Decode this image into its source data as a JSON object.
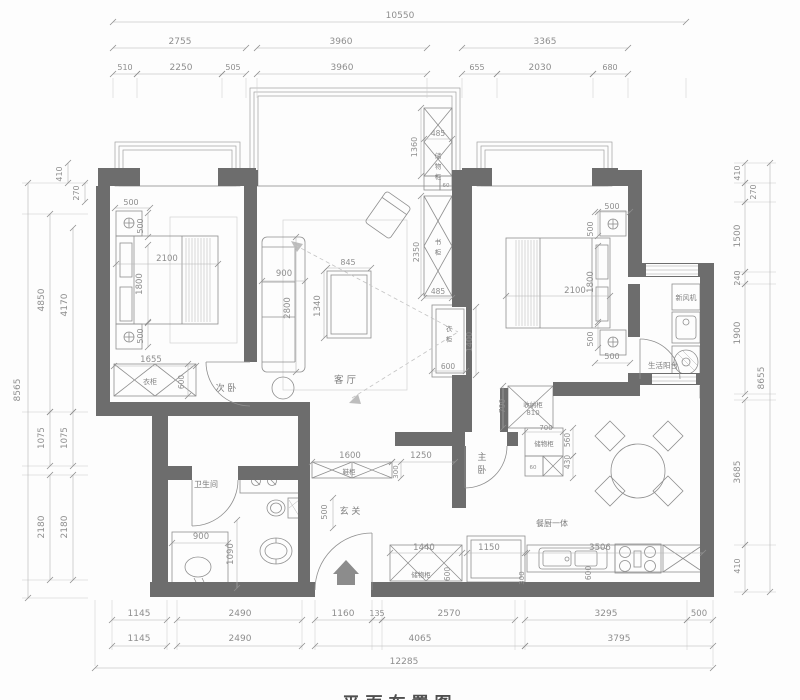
{
  "drawing": {
    "type": "apartment-floor-plan",
    "caption": "平面布置图",
    "room_labels": [
      "次 卧",
      "客 厅",
      "主卧",
      "玄 关",
      "卫生间",
      "餐厨一体",
      "生活阳台"
    ],
    "cabinet_labels": [
      "衣柜",
      "书柜",
      "储物柜",
      "收纳柜",
      "鞋柜",
      "新风机"
    ],
    "overall_dimensions": {
      "top": "10550",
      "bottom": "12285",
      "left": "8565",
      "right": "8655"
    },
    "annotations": [
      {
        "n": "dim-top-total",
        "t": "10550",
        "x": 400,
        "y": 18
      },
      {
        "n": "dim-top-2755",
        "t": "2755",
        "x": 180,
        "y": 44
      },
      {
        "n": "dim-top-3960a",
        "t": "3960",
        "x": 341,
        "y": 44
      },
      {
        "n": "dim-top-3365",
        "t": "3365",
        "x": 545,
        "y": 44
      },
      {
        "n": "dim-top-510",
        "t": "510",
        "x": 125,
        "y": 70,
        "s": 8
      },
      {
        "n": "dim-top-2250",
        "t": "2250",
        "x": 181,
        "y": 70
      },
      {
        "n": "dim-top-505",
        "t": "505",
        "x": 233,
        "y": 70,
        "s": 8
      },
      {
        "n": "dim-top-3960b",
        "t": "3960",
        "x": 342,
        "y": 70
      },
      {
        "n": "dim-top-655",
        "t": "655",
        "x": 477,
        "y": 70,
        "s": 8
      },
      {
        "n": "dim-top-2030",
        "t": "2030",
        "x": 540,
        "y": 70
      },
      {
        "n": "dim-top-680",
        "t": "680",
        "x": 610,
        "y": 70,
        "s": 8
      },
      {
        "n": "dim-left-8565",
        "t": "8565",
        "x": 20,
        "y": 390,
        "r": -90
      },
      {
        "n": "dim-left-4850",
        "t": "4850",
        "x": 44,
        "y": 300,
        "r": -90
      },
      {
        "n": "dim-left-4170",
        "t": "4170",
        "x": 67,
        "y": 305,
        "r": -90
      },
      {
        "n": "dim-left-410",
        "t": "410",
        "x": 62,
        "y": 174,
        "r": -90,
        "s": 8
      },
      {
        "n": "dim-left-270",
        "t": "270",
        "x": 79,
        "y": 193,
        "r": -90,
        "s": 8
      },
      {
        "n": "dim-left-1075a",
        "t": "1075",
        "x": 44,
        "y": 438,
        "r": -90,
        "s": 8.5
      },
      {
        "n": "dim-left-1075b",
        "t": "1075",
        "x": 67,
        "y": 438,
        "r": -90,
        "s": 8.5
      },
      {
        "n": "dim-left-2180a",
        "t": "2180",
        "x": 44,
        "y": 527,
        "r": -90
      },
      {
        "n": "dim-left-2180b",
        "t": "2180",
        "x": 67,
        "y": 527,
        "r": -90
      },
      {
        "n": "dim-right-410t",
        "t": "410",
        "x": 740,
        "y": 173,
        "r": -90,
        "s": 8
      },
      {
        "n": "dim-right-270",
        "t": "270",
        "x": 756,
        "y": 192,
        "r": -90,
        "s": 8
      },
      {
        "n": "dim-right-1500",
        "t": "1500",
        "x": 740,
        "y": 236,
        "r": -90
      },
      {
        "n": "dim-right-240",
        "t": "240",
        "x": 740,
        "y": 278,
        "r": -90,
        "s": 8
      },
      {
        "n": "dim-right-1900",
        "t": "1900",
        "x": 740,
        "y": 333,
        "r": -90
      },
      {
        "n": "dim-right-8655",
        "t": "8655",
        "x": 764,
        "y": 378,
        "r": -90
      },
      {
        "n": "dim-right-3685",
        "t": "3685",
        "x": 740,
        "y": 472,
        "r": -90
      },
      {
        "n": "dim-right-410b",
        "t": "410",
        "x": 740,
        "y": 566,
        "r": -90,
        "s": 8
      },
      {
        "n": "dim-bot-1145a",
        "t": "1145",
        "x": 139,
        "y": 616
      },
      {
        "n": "dim-bot-2490a",
        "t": "2490",
        "x": 240,
        "y": 616
      },
      {
        "n": "dim-bot-1160",
        "t": "1160",
        "x": 343,
        "y": 616
      },
      {
        "n": "dim-bot-135",
        "t": "135",
        "x": 377,
        "y": 616,
        "s": 8
      },
      {
        "n": "dim-bot-2570",
        "t": "2570",
        "x": 449,
        "y": 616
      },
      {
        "n": "dim-bot-3295",
        "t": "3295",
        "x": 606,
        "y": 616
      },
      {
        "n": "dim-bot-500",
        "t": "500",
        "x": 699,
        "y": 616,
        "s": 8.5
      },
      {
        "n": "dim-bot-1145b",
        "t": "1145",
        "x": 139,
        "y": 641
      },
      {
        "n": "dim-bot-2490b",
        "t": "2490",
        "x": 240,
        "y": 641
      },
      {
        "n": "dim-bot-4065",
        "t": "4065",
        "x": 420,
        "y": 641
      },
      {
        "n": "dim-bot-3795",
        "t": "3795",
        "x": 619,
        "y": 641
      },
      {
        "n": "dim-bot-12285",
        "t": "12285",
        "x": 404,
        "y": 664
      },
      {
        "n": "dim-br2-500t",
        "t": "500",
        "x": 131,
        "y": 205,
        "s": 8
      },
      {
        "n": "dim-br2-500v1",
        "t": "500",
        "x": 143,
        "y": 226,
        "r": -90,
        "s": 8
      },
      {
        "n": "dim-br2-2100",
        "t": "2100",
        "x": 167,
        "y": 261,
        "s": 8.5
      },
      {
        "n": "dim-br2-1800",
        "t": "1800",
        "x": 142,
        "y": 284,
        "r": -90,
        "s": 8.5
      },
      {
        "n": "dim-br2-500v2",
        "t": "500",
        "x": 143,
        "y": 336,
        "r": -90,
        "s": 8
      },
      {
        "n": "dim-br2-1655",
        "t": "1655",
        "x": 151,
        "y": 362,
        "s": 8.5
      },
      {
        "n": "dim-br2-600",
        "t": "600",
        "x": 184,
        "y": 382,
        "r": -90,
        "s": 7.5
      },
      {
        "n": "dim-lv-900",
        "t": "900",
        "x": 284,
        "y": 276,
        "s": 8.5
      },
      {
        "n": "dim-lv-2800",
        "t": "2800",
        "x": 290,
        "y": 308,
        "r": -90,
        "s": 8.5
      },
      {
        "n": "dim-lv-845",
        "t": "845",
        "x": 348,
        "y": 265,
        "s": 8
      },
      {
        "n": "dim-lv-1340",
        "t": "1340",
        "x": 320,
        "y": 306,
        "r": -90,
        "s": 8.5
      },
      {
        "n": "dim-cab-1360",
        "t": "1360",
        "x": 417,
        "y": 147,
        "r": -90,
        "s": 8
      },
      {
        "n": "dim-cab-485t",
        "t": "485",
        "x": 438,
        "y": 136,
        "s": 7.5
      },
      {
        "n": "dim-cab-60t",
        "t": "60",
        "x": 446,
        "y": 187,
        "s": 5.5
      },
      {
        "n": "dim-bk-2350",
        "t": "2350",
        "x": 419,
        "y": 252,
        "r": -90,
        "s": 8
      },
      {
        "n": "dim-bk-485b",
        "t": "485",
        "x": 438,
        "y": 294,
        "s": 7.5
      },
      {
        "n": "dim-tv-1400",
        "t": "1400",
        "x": 472,
        "y": 342,
        "r": -90,
        "s": 8
      },
      {
        "n": "dim-tv-600",
        "t": "600",
        "x": 448,
        "y": 369,
        "s": 7.5
      },
      {
        "n": "dim-mb-500t",
        "t": "500",
        "x": 612,
        "y": 209,
        "s": 8
      },
      {
        "n": "dim-mb-500v1",
        "t": "500",
        "x": 593,
        "y": 229,
        "r": -90,
        "s": 8
      },
      {
        "n": "dim-mb-2100",
        "t": "2100",
        "x": 575,
        "y": 293,
        "s": 8.5
      },
      {
        "n": "dim-mb-1800",
        "t": "1800",
        "x": 593,
        "y": 282,
        "r": -90,
        "s": 8.5
      },
      {
        "n": "dim-mb-500v2",
        "t": "500",
        "x": 593,
        "y": 339,
        "r": -90,
        "s": 8
      },
      {
        "n": "dim-mb-500b",
        "t": "500",
        "x": 612,
        "y": 359,
        "s": 8
      },
      {
        "n": "dim-mid-790",
        "t": "790",
        "x": 505,
        "y": 406,
        "r": -90,
        "s": 7.5
      },
      {
        "n": "dim-mid-810",
        "t": "810",
        "x": 533,
        "y": 415,
        "s": 7
      },
      {
        "n": "dim-mid-700",
        "t": "700",
        "x": 546,
        "y": 430,
        "s": 7
      },
      {
        "n": "dim-mid-560",
        "t": "560",
        "x": 570,
        "y": 440,
        "r": -90,
        "s": 7.5
      },
      {
        "n": "dim-mid-430",
        "t": "430",
        "x": 570,
        "y": 462,
        "r": -90,
        "s": 7.5
      },
      {
        "n": "dim-mid-60",
        "t": "60",
        "x": 533,
        "y": 469,
        "s": 5.5
      },
      {
        "n": "dim-en-1600",
        "t": "1600",
        "x": 350,
        "y": 458,
        "s": 8.5
      },
      {
        "n": "dim-en-1250",
        "t": "1250",
        "x": 421,
        "y": 458,
        "s": 8.5
      },
      {
        "n": "dim-en-300",
        "t": "300",
        "x": 398,
        "y": 472,
        "r": -90,
        "s": 7
      },
      {
        "n": "dim-en-500",
        "t": "500",
        "x": 327,
        "y": 512,
        "r": -90,
        "s": 8
      },
      {
        "n": "dim-ba-900",
        "t": "900",
        "x": 201,
        "y": 539,
        "s": 8.5
      },
      {
        "n": "dim-ba-1090",
        "t": "1090",
        "x": 233,
        "y": 554,
        "r": -90,
        "s": 8.5
      },
      {
        "n": "dim-kt-1440",
        "t": "1440",
        "x": 424,
        "y": 550,
        "s": 8.5
      },
      {
        "n": "dim-kt-600a",
        "t": "600",
        "x": 450,
        "y": 574,
        "r": -90,
        "s": 7.5
      },
      {
        "n": "dim-kt-1150",
        "t": "1150",
        "x": 489,
        "y": 550,
        "s": 8.5
      },
      {
        "n": "dim-kt-3506",
        "t": "3506",
        "x": 600,
        "y": 550,
        "s": 8.5
      },
      {
        "n": "dim-kt-300",
        "t": "300",
        "x": 524,
        "y": 578,
        "r": -90,
        "s": 7
      },
      {
        "n": "dim-kt-600b",
        "t": "600",
        "x": 591,
        "y": 573,
        "r": -90,
        "s": 7.5
      },
      {
        "n": "room-label-bedroom2",
        "t": "次 卧",
        "x": 226,
        "y": 391,
        "k": "label",
        "s": 9
      },
      {
        "n": "cabinet-label-wardrobe2",
        "t": "衣柜",
        "x": 150,
        "y": 384,
        "k": "label",
        "s": 7
      },
      {
        "n": "room-label-living",
        "t": "客 厅",
        "x": 345,
        "y": 383,
        "k": "label",
        "s": 9.5
      },
      {
        "n": "cabinet-label-top-storage",
        "t": "储物柜",
        "x": 438,
        "y": 158,
        "k": "label",
        "s": 6.5,
        "v": 1
      },
      {
        "n": "cabinet-label-bookcase",
        "t": "书柜",
        "x": 438,
        "y": 244,
        "k": "label",
        "s": 6.5,
        "v": 1
      },
      {
        "n": "cabinet-label-tv-wardrobe",
        "t": "衣柜",
        "x": 449,
        "y": 331,
        "k": "label",
        "s": 6.5,
        "v": 1
      },
      {
        "n": "room-label-master",
        "t": "主卧",
        "x": 482,
        "y": 460,
        "k": "label",
        "s": 9,
        "v": 1
      },
      {
        "n": "cabinet-label-shounagui",
        "t": "收纳柜",
        "x": 533,
        "y": 407,
        "k": "label",
        "s": 6.5
      },
      {
        "n": "cabinet-label-storage560",
        "t": "储物柜",
        "x": 544,
        "y": 446,
        "k": "label",
        "s": 6.5
      },
      {
        "n": "appliance-label-freshair",
        "t": "新风机",
        "x": 686,
        "y": 300,
        "k": "label",
        "s": 7
      },
      {
        "n": "room-label-balcony",
        "t": "生活阳台",
        "x": 663,
        "y": 368,
        "k": "label",
        "s": 7.5
      },
      {
        "n": "cabinet-label-shoe",
        "t": "鞋柜",
        "x": 349,
        "y": 474,
        "k": "label",
        "s": 6.5
      },
      {
        "n": "room-label-entry",
        "t": "玄 关",
        "x": 350,
        "y": 514,
        "k": "label",
        "s": 9
      },
      {
        "n": "room-label-bath",
        "t": "卫生间",
        "x": 206,
        "y": 487,
        "k": "label",
        "s": 8
      },
      {
        "n": "cabinet-label-kitchen-storage",
        "t": "储物柜",
        "x": 421,
        "y": 577,
        "k": "label",
        "s": 6.5
      },
      {
        "n": "room-label-kitchen",
        "t": "餐厨一体",
        "x": 552,
        "y": 526,
        "k": "label",
        "s": 8
      },
      {
        "n": "drawing-caption",
        "t": "平面布置图",
        "x": 400,
        "y": 709,
        "k": "caption",
        "s": 17
      }
    ]
  }
}
